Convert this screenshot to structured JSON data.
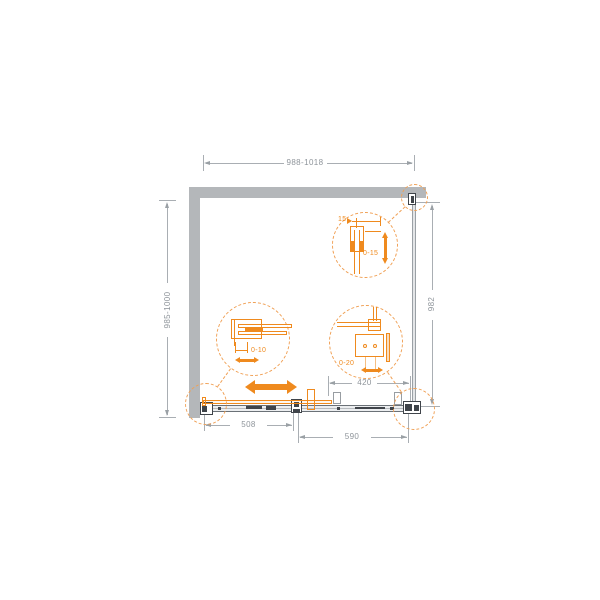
{
  "drawing": {
    "type": "shower-enclosure-plan-diagram",
    "dimensions": {
      "overall_width": "988-1018",
      "side_depth": "985-1000",
      "right_panel": "982",
      "fixed_section": "420",
      "door_section_left": "508",
      "door_section_right": "590"
    },
    "callouts": {
      "wall_profile": {
        "profile_width": "15",
        "adjustment": "0-15"
      },
      "door_overlap": {
        "adjustment": "0-10"
      },
      "panel_mount": {
        "adjustment": "0-20"
      }
    },
    "icons": {
      "slide-direction-arrow": "css-double-headed-horizontal-arrow",
      "height-adjust-arrow": "css-double-headed-vertical-arrow",
      "overlap-adjust-arrow": "css-double-headed-horizontal-arrow",
      "mount-adjust-arrow": "css-double-headed-horizontal-arrow"
    },
    "colors": {
      "accent_orange": "#EF8A1E",
      "callout_orange": "#F0A055",
      "wall_gray": "#B4B7BA",
      "dim_line_gray": "#A9AEB3",
      "dim_text_gray": "#8E949A",
      "hardware_dark": "#3F444A"
    }
  }
}
